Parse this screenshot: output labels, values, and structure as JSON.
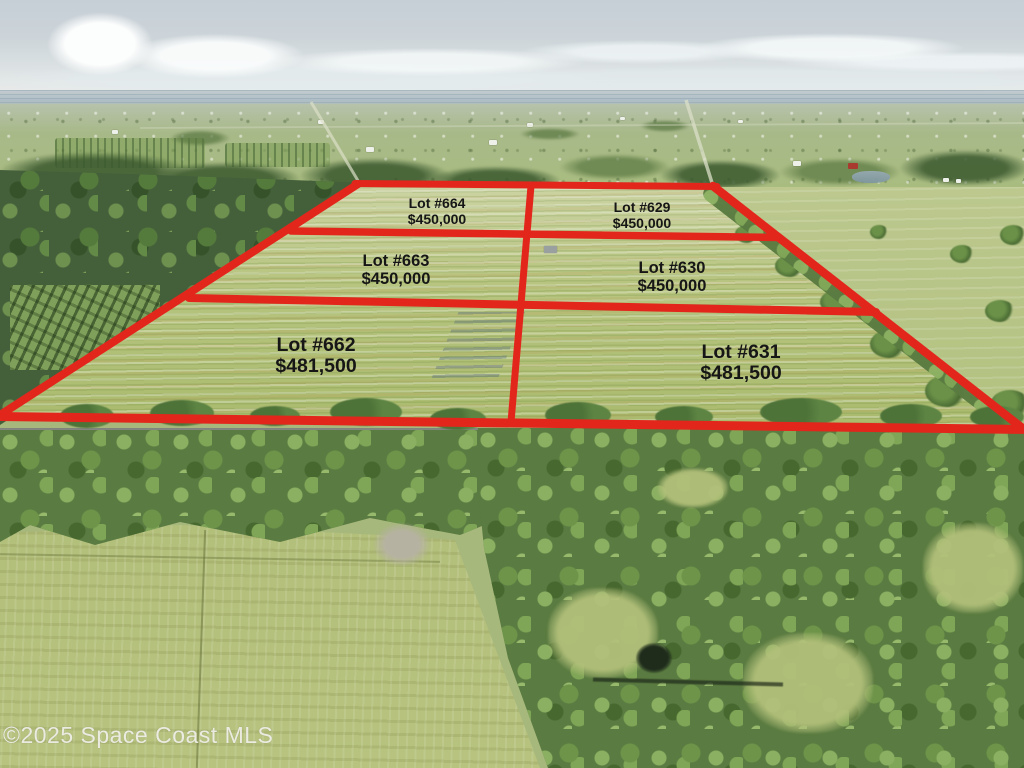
{
  "lots": [
    {
      "name": "Lot #664",
      "price": "$450,000"
    },
    {
      "name": "Lot #629",
      "price": "$450,000"
    },
    {
      "name": "Lot #663",
      "price": "$450,000"
    },
    {
      "name": "Lot #630",
      "price": "$450,000"
    },
    {
      "name": "Lot #662",
      "price": "$481,500"
    },
    {
      "name": "Lot #631",
      "price": "$481,500"
    }
  ],
  "watermark": "©2025 Space Coast MLS",
  "colors": {
    "lot_boundary": "#e3261c",
    "label_text": "#161616"
  }
}
